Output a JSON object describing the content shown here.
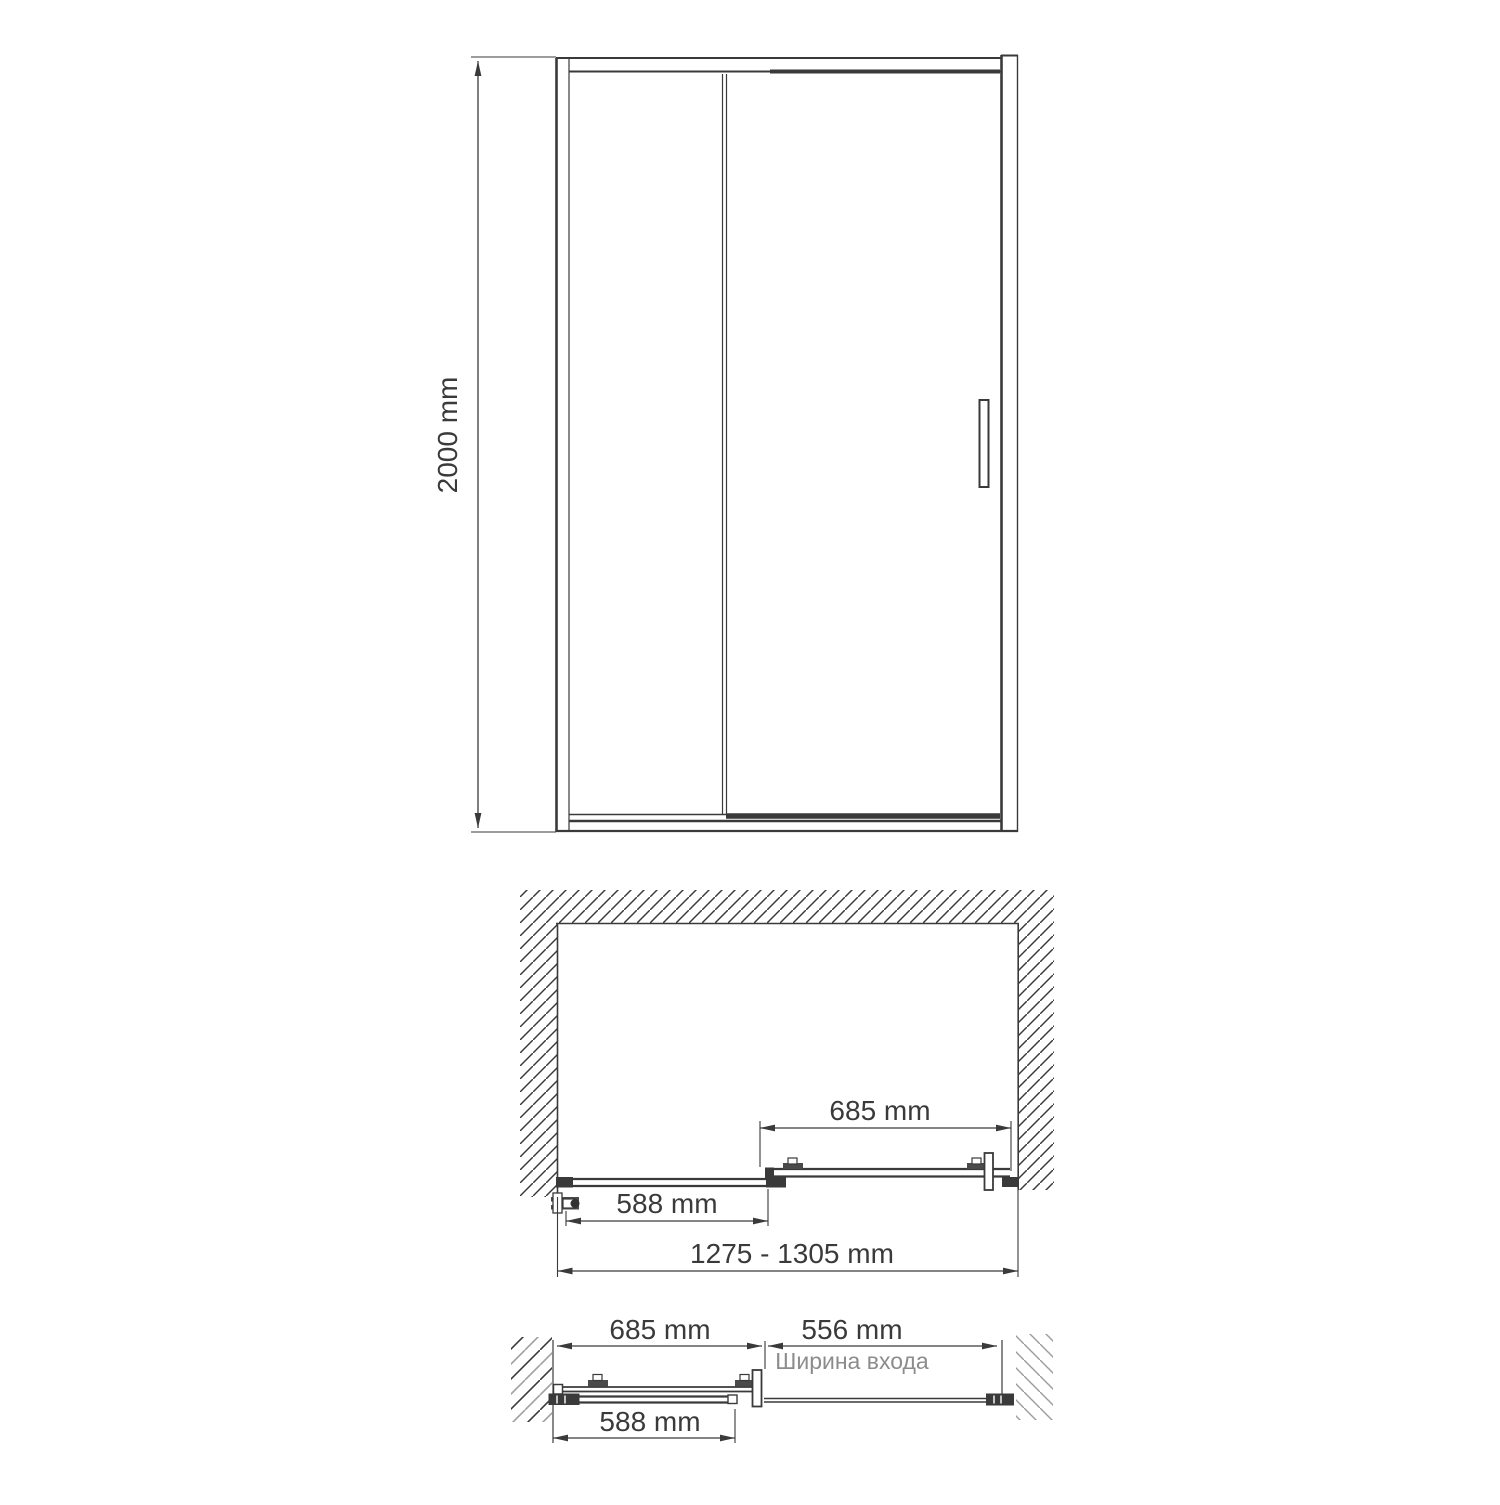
{
  "drawing": {
    "title_semantic": "sliding shower door technical drawing",
    "line_color": "#3a3a3a",
    "text_color": "#3a3a3a",
    "caption_color": "#8c8c8c",
    "hatch_dark_color": "#3a3a3a",
    "hatch_gray_color": "#9e9e9e",
    "background_color": "#ffffff",
    "front_view": {
      "height_label": "2000 mm"
    },
    "plan_view_closed": {
      "door_panel_width_label": "685 mm",
      "fixed_glass_width_label": "588 mm",
      "overall_width_range_label": "1275 - 1305 mm"
    },
    "plan_view_open": {
      "door_panel_width_label": "685 mm",
      "entrance_width_label": "556 mm",
      "entrance_caption": "Ширина входа",
      "fixed_glass_width_label": "588 mm"
    }
  }
}
